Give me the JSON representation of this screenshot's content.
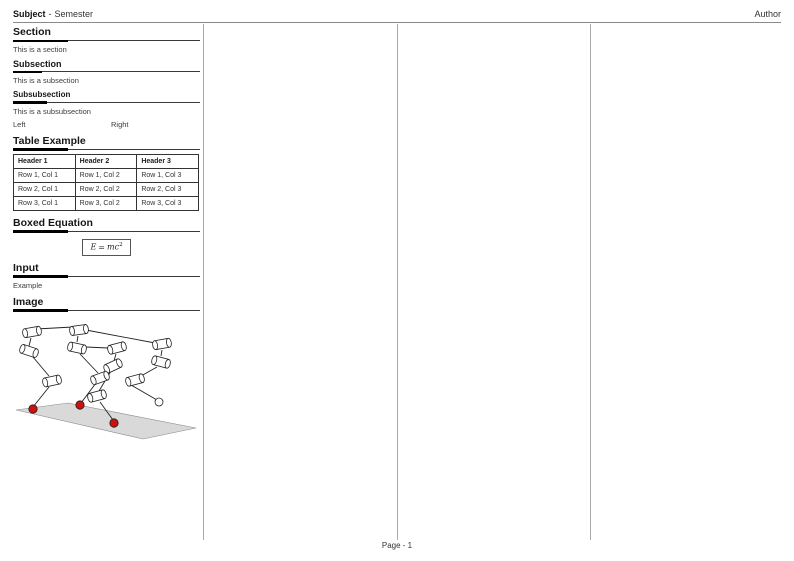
{
  "header": {
    "subject": "Subject",
    "separator": "-",
    "semester": "Semester",
    "author": "Author"
  },
  "footer": {
    "page_label": "Page - 1"
  },
  "sections": {
    "section": {
      "title": "Section",
      "body": "This is a section"
    },
    "subsection": {
      "title": "Subsection",
      "body": "This is a subsection"
    },
    "subsubsection": {
      "title": "Subsubsection",
      "body": "This is a subsubsection"
    },
    "two_columns": {
      "left": "Left",
      "right": "Right"
    },
    "table_example": {
      "title": "Table Example",
      "headers": [
        "Header 1",
        "Header 2",
        "Header 3"
      ],
      "rows": [
        [
          "Row 1, Col 1",
          "Row 1, Col 2",
          "Row 1, Col 3"
        ],
        [
          "Row 2, Col 1",
          "Row 2, Col 2",
          "Row 2, Col 3"
        ],
        [
          "Row 3, Col 1",
          "Row 3, Col 2",
          "Row 3, Col 3"
        ]
      ]
    },
    "boxed_equation": {
      "title": "Boxed Equation",
      "lhs": "E",
      "relation": "=",
      "rhs": "mc",
      "exponent": "2"
    },
    "input": {
      "title": "Input",
      "body": "Example"
    },
    "image": {
      "title": "Image",
      "description": "multibody-linkage-figure"
    }
  },
  "figure": {
    "ground": [
      [
        16,
        359
      ],
      [
        68,
        352
      ],
      [
        196,
        377
      ],
      [
        143,
        388
      ]
    ],
    "cylinders": [
      [
        32,
        281,
        -10
      ],
      [
        29,
        300,
        18
      ],
      [
        79,
        279,
        -8
      ],
      [
        77,
        297,
        12
      ],
      [
        117,
        297,
        -15
      ],
      [
        162,
        293,
        -10
      ],
      [
        161,
        311,
        15
      ],
      [
        113,
        315,
        -25
      ],
      [
        52,
        330,
        -12
      ],
      [
        100,
        327,
        -20
      ],
      [
        97,
        345,
        -15
      ],
      [
        135,
        329,
        -15
      ]
    ],
    "links": [
      [
        36,
        278,
        73,
        276
      ],
      [
        86,
        279,
        155,
        292
      ],
      [
        31,
        287,
        29,
        295
      ],
      [
        33,
        306,
        49,
        325
      ],
      [
        49,
        336,
        33,
        356
      ],
      [
        78,
        285,
        77,
        291
      ],
      [
        86,
        296,
        108,
        297
      ],
      [
        80,
        303,
        98,
        322
      ],
      [
        116,
        303,
        114,
        310
      ],
      [
        111,
        320,
        99,
        340
      ],
      [
        96,
        332,
        81,
        352
      ],
      [
        100,
        351,
        113,
        369
      ],
      [
        162,
        299,
        161,
        305
      ],
      [
        157,
        316,
        141,
        325
      ],
      [
        131,
        334,
        157,
        349
      ]
    ],
    "contact_points": [
      [
        33,
        358
      ],
      [
        80,
        354
      ],
      [
        114,
        372
      ]
    ],
    "free_joint": [
      159,
      351
    ],
    "colors": {
      "contact_red": "#cc1111",
      "ground_fill": "#d9d9d9",
      "ground_stroke": "#888888",
      "outline": "#222222",
      "cylinder_fill": "#ffffff"
    }
  }
}
